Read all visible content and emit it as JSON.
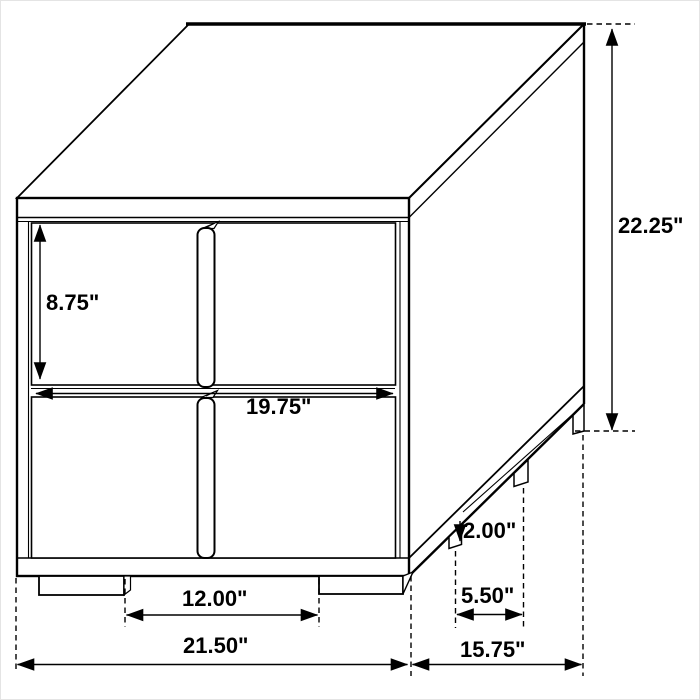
{
  "figure": {
    "subject": "two-drawer nightstand line drawing",
    "view": "three-quarter front/right perspective",
    "units": "inches",
    "line_color": "#000000",
    "background_color": "#ffffff"
  },
  "labels": {
    "drawer_height": "8.75\"",
    "drawer_width": "19.75\"",
    "overall_height": "22.25\"",
    "leg_height": "2.00\"",
    "side_leg_spacing": "5.50\"",
    "front_leg_spacing": "12.00\"",
    "overall_width": "21.50\"",
    "overall_depth": "15.75\""
  },
  "measurements": [
    {
      "label": "8.75\"",
      "value": 8.75,
      "unit": "in",
      "measures": "drawer front height"
    },
    {
      "label": "19.75\"",
      "value": 19.75,
      "unit": "in",
      "measures": "drawer front width"
    },
    {
      "label": "22.25\"",
      "value": 22.25,
      "unit": "in",
      "measures": "overall height"
    },
    {
      "label": "2.00\"",
      "value": 2.0,
      "unit": "in",
      "measures": "leg height"
    },
    {
      "label": "5.50\"",
      "value": 5.5,
      "unit": "in",
      "measures": "side leg spacing"
    },
    {
      "label": "12.00\"",
      "value": 12.0,
      "unit": "in",
      "measures": "front leg spacing"
    },
    {
      "label": "21.50\"",
      "value": 21.5,
      "unit": "in",
      "measures": "overall width"
    },
    {
      "label": "15.75\"",
      "value": 15.75,
      "unit": "in",
      "measures": "overall depth"
    }
  ]
}
